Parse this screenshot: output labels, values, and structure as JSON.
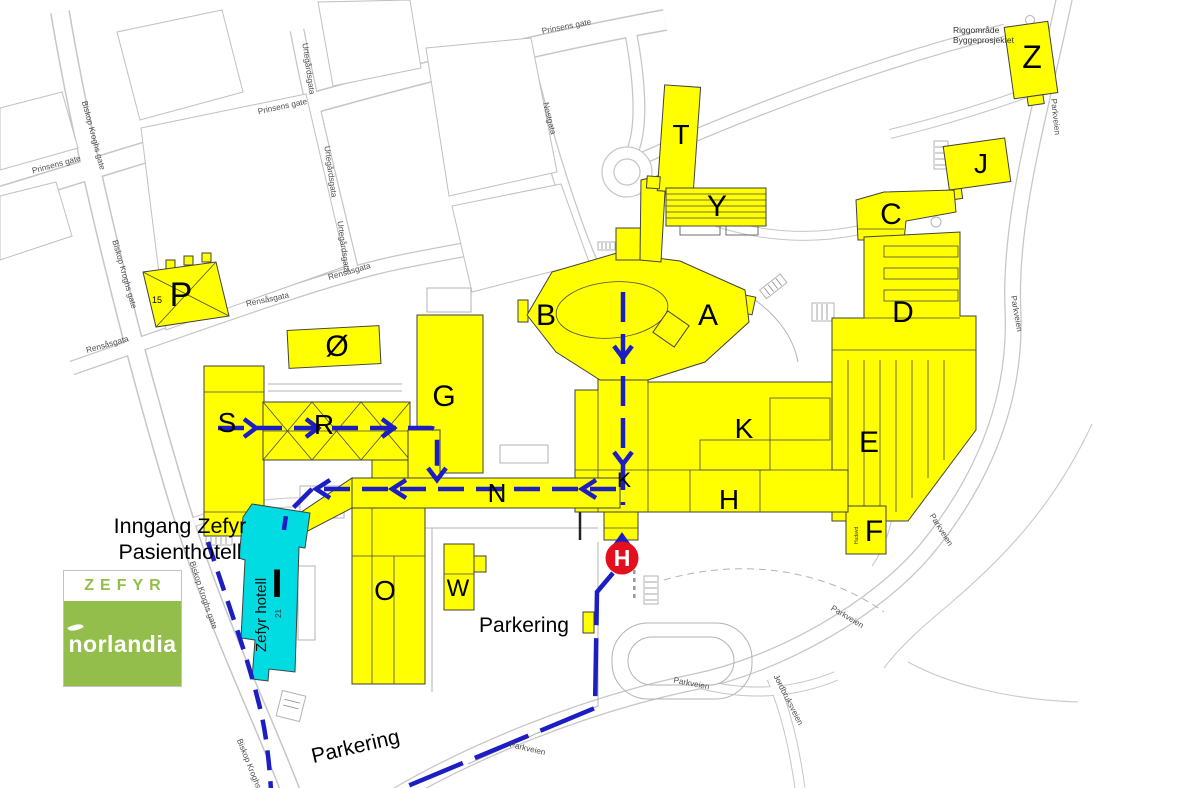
{
  "colors": {
    "building_yellow": "#ffff00",
    "hotel_cyan": "#00dce2",
    "route_blue": "#1d1dc4",
    "marker_red": "#e30e1e",
    "logo_green": "#94be4b",
    "road_gray": "#c6c6c6",
    "street_text_gray": "#4d4d4d"
  },
  "logo": {
    "top": "ZEFYR",
    "bottom": "norlandia"
  },
  "entrance_note": {
    "line1": "Inngang Zefyr",
    "line2": "Pasienthotell"
  },
  "construction_area": {
    "line1": "Riggområde",
    "line2": "Byggeprosjektet"
  },
  "marker": {
    "label": "H"
  },
  "hotel": {
    "letter": "I",
    "name": "Zefyr hotell",
    "number": "21"
  },
  "parking": {
    "label_main": "Parkering",
    "label_lower": "Parkering"
  },
  "buildings": {
    "a": "A",
    "b": "B",
    "c": "C",
    "d": "D",
    "e": "E",
    "f": "F",
    "g": "G",
    "h": "H",
    "j": "J",
    "k": "K",
    "k2": "K",
    "n": "N",
    "o": "O",
    "p": "P",
    "r": "R",
    "s": "S",
    "t": "T",
    "w": "W",
    "y": "Y",
    "z": "Z",
    "oe": "Ø"
  },
  "numbers": {
    "p_building": "15"
  },
  "annotations": {
    "f_side": "Hudavd"
  },
  "streets": [
    {
      "name": "Prinsens gate"
    },
    {
      "name": "Prinsens gate"
    },
    {
      "name": "Prinsens gate"
    },
    {
      "name": "Biskop Kroghs gate"
    },
    {
      "name": "Biskop Kroghs gate"
    },
    {
      "name": "Biskop Kroghs gate"
    },
    {
      "name": "Biskop Kroghs gate"
    },
    {
      "name": "Urtegårdsgata"
    },
    {
      "name": "Urtegårdsgata"
    },
    {
      "name": "Urtegårdsgata"
    },
    {
      "name": "Nostgata"
    },
    {
      "name": "Rensåsgata"
    },
    {
      "name": "Rensåsgata"
    },
    {
      "name": "Rensåsgata"
    },
    {
      "name": "Parkveien"
    },
    {
      "name": "Parkveien"
    },
    {
      "name": "Parkveien"
    },
    {
      "name": "Parkveien"
    },
    {
      "name": "Parkveien"
    },
    {
      "name": "Parkveien"
    },
    {
      "name": "Jordbruksveien"
    }
  ]
}
